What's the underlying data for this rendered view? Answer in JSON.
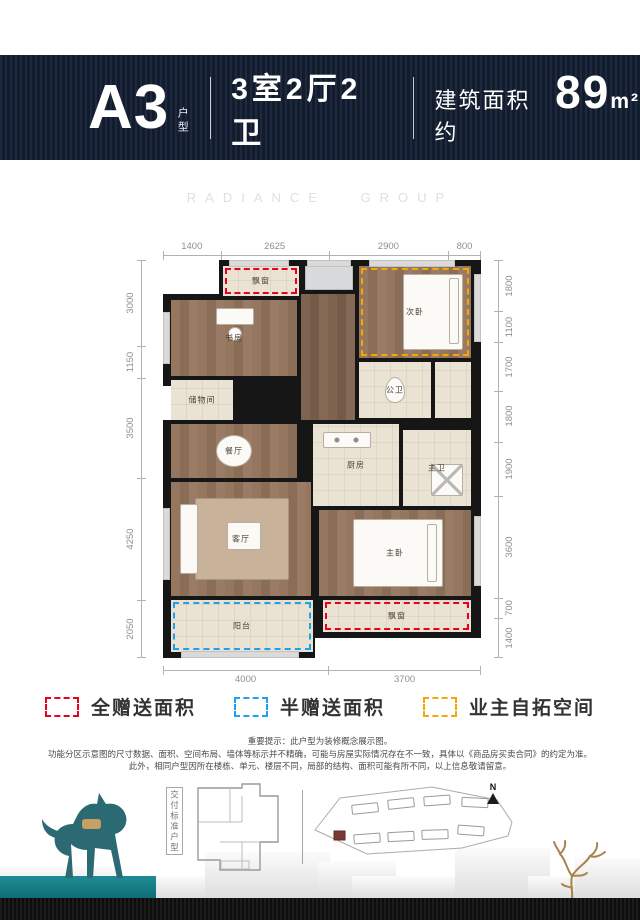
{
  "header": {
    "unit": "A3",
    "unit_suffix": "户型",
    "layout": "3室2厅2卫",
    "area_prefix": "建筑面积约",
    "area_value": "89",
    "area_unit": "m²"
  },
  "watermark": "RADIANCE GROUP",
  "floorplan": {
    "dims_top": [
      "1400",
      "2625",
      "2900",
      "800"
    ],
    "dims_left": [
      "3000",
      "1150",
      "3500",
      "4250",
      "2050"
    ],
    "dims_right": [
      "1800",
      "1100",
      "1700",
      "1800",
      "1900",
      "3600",
      "700",
      "1400"
    ],
    "dims_bottom": [
      "4000",
      "3700"
    ],
    "rooms": [
      {
        "name": "bay-window-top",
        "label": "飘窗",
        "x": 60,
        "y": 6,
        "w": 76,
        "h": 30,
        "floor": "tile",
        "overlay": "red"
      },
      {
        "name": "equipment-platform",
        "label": "",
        "x": 142,
        "y": 6,
        "w": 48,
        "h": 24,
        "floor": "gray"
      },
      {
        "name": "second-bedroom",
        "label": "次卧",
        "x": 196,
        "y": 6,
        "w": 112,
        "h": 92,
        "floor": "wood",
        "overlay": "orange",
        "furn": "bed-v"
      },
      {
        "name": "study",
        "label": "书房",
        "x": 8,
        "y": 40,
        "w": 126,
        "h": 76,
        "floor": "wood",
        "furn": "desk"
      },
      {
        "name": "hallway",
        "label": "",
        "x": 138,
        "y": 34,
        "w": 54,
        "h": 126,
        "floor": "wood2"
      },
      {
        "name": "storage",
        "label": "储物间",
        "x": 8,
        "y": 120,
        "w": 62,
        "h": 40,
        "floor": "tile"
      },
      {
        "name": "guest-bathroom",
        "label": "公卫",
        "x": 196,
        "y": 102,
        "w": 72,
        "h": 56,
        "floor": "tile",
        "furn": "wc"
      },
      {
        "name": "closet",
        "label": "",
        "x": 272,
        "y": 102,
        "w": 36,
        "h": 56,
        "floor": "tile"
      },
      {
        "name": "dining-room",
        "label": "餐厅",
        "x": 8,
        "y": 164,
        "w": 126,
        "h": 54,
        "floor": "wood",
        "furn": "dining"
      },
      {
        "name": "kitchen",
        "label": "厨房",
        "x": 150,
        "y": 164,
        "w": 86,
        "h": 82,
        "floor": "tile",
        "furn": "stove"
      },
      {
        "name": "master-bathroom",
        "label": "主卫",
        "x": 240,
        "y": 170,
        "w": 68,
        "h": 76,
        "floor": "tile",
        "furn": "shower"
      },
      {
        "name": "living-room",
        "label": "客厅",
        "x": 8,
        "y": 222,
        "w": 140,
        "h": 114,
        "floor": "wood",
        "furn": "sofa"
      },
      {
        "name": "master-bedroom",
        "label": "主卧",
        "x": 156,
        "y": 250,
        "w": 152,
        "h": 86,
        "floor": "wood",
        "furn": "bed-h"
      },
      {
        "name": "balcony",
        "label": "阳台",
        "x": 8,
        "y": 340,
        "w": 142,
        "h": 52,
        "floor": "tile",
        "overlay": "blue"
      },
      {
        "name": "bay-window-bottom",
        "label": "飘窗",
        "x": 160,
        "y": 340,
        "w": 148,
        "h": 32,
        "floor": "tile",
        "overlay": "red"
      }
    ],
    "windows": [
      {
        "x": 66,
        "y": 0,
        "w": 60,
        "h": 7
      },
      {
        "x": 144,
        "y": 0,
        "w": 44,
        "h": 7
      },
      {
        "x": 206,
        "y": 0,
        "w": 86,
        "h": 7
      },
      {
        "x": 0,
        "y": 52,
        "w": 7,
        "h": 52
      },
      {
        "x": 0,
        "y": 248,
        "w": 7,
        "h": 72
      },
      {
        "x": 311,
        "y": 14,
        "w": 7,
        "h": 68
      },
      {
        "x": 311,
        "y": 256,
        "w": 7,
        "h": 70
      },
      {
        "x": 18,
        "y": 391,
        "w": 118,
        "h": 7
      }
    ],
    "openings": [
      {
        "x": 0,
        "y": 126,
        "w": 8,
        "h": 34
      }
    ],
    "cutouts": [
      {
        "x": 0,
        "y": 0,
        "w": 56,
        "h": 34
      },
      {
        "x": 152,
        "y": 378,
        "w": 166,
        "h": 20
      }
    ]
  },
  "legend": [
    {
      "label": "全赠送面积",
      "color": "#e8001e"
    },
    {
      "label": "半赠送面积",
      "color": "#1fa0ea"
    },
    {
      "label": "业主自拓空间",
      "color": "#f7a800"
    }
  ],
  "disclaimer": [
    "重要提示：此户型为装修概念展示图。",
    "功能分区示意图的尺寸数据、面积、空间布局、墙体等标示并不精确，可能与房屋实际情况存在不一致，具体以《商品房买卖合同》的约定为准。",
    "此外，相同户型因所在楼栋、单元、楼层不同，局部的结构、面积可能有所不同，以上信息敬请留意。"
  ],
  "footer": {
    "standard_label": "交付标准户型",
    "north_label": "N"
  },
  "footer_blocks": [
    {
      "x": 0,
      "y": 866,
      "w": 120,
      "h": 32
    },
    {
      "x": 120,
      "y": 876,
      "w": 110,
      "h": 22
    },
    {
      "x": 205,
      "y": 852,
      "w": 125,
      "h": 46
    },
    {
      "x": 318,
      "y": 862,
      "w": 78,
      "h": 36
    },
    {
      "x": 352,
      "y": 876,
      "w": 150,
      "h": 22
    },
    {
      "x": 455,
      "y": 848,
      "w": 95,
      "h": 50
    },
    {
      "x": 528,
      "y": 876,
      "w": 112,
      "h": 22
    },
    {
      "x": 575,
      "y": 858,
      "w": 65,
      "h": 40
    }
  ],
  "colors": {
    "navy": "#141d2c",
    "red": "#e8001e",
    "blue": "#1fa0ea",
    "orange": "#f7a800",
    "teal": "#17828b"
  }
}
